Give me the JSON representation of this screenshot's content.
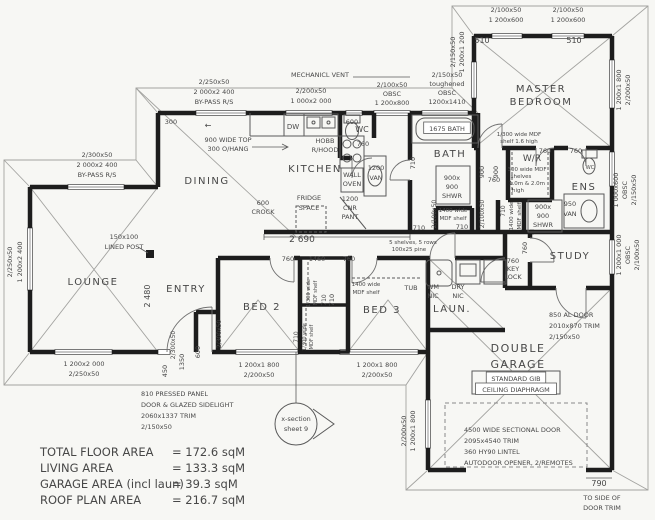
{
  "title": "house-floor-plan",
  "colors": {
    "paper": "#f7f7f4",
    "ink": "#474747",
    "wall": "#1d1d1d",
    "thin": "#9a9a9a"
  },
  "areas": [
    {
      "label": "TOTAL FLOOR AREA",
      "value": "= 172.6 sqM"
    },
    {
      "label": "LIVING AREA",
      "value": "= 133.3 sqM"
    },
    {
      "label": "GARAGE AREA (incl laun)",
      "value": "= 39.3 sqM"
    },
    {
      "label": "ROOF PLAN AREA",
      "value": "= 216.7 sqM"
    }
  ],
  "labels": [
    {
      "n": "win-dining-size",
      "t": "2/250x50",
      "x": 214,
      "y": 84
    },
    {
      "n": "win-dining-glass",
      "t": "2 000x2 400",
      "x": 214,
      "y": 94
    },
    {
      "n": "win-dining-type",
      "t": "BY-PASS R/S",
      "x": 214,
      "y": 104
    },
    {
      "n": "dim-300",
      "t": "300",
      "x": 171,
      "y": 124
    },
    {
      "n": "note-bench-top-1",
      "t": "900 WIDE TOP",
      "x": 228,
      "y": 142
    },
    {
      "n": "note-bench-top-2",
      "t": "300 O/HANG",
      "x": 228,
      "y": 151
    },
    {
      "n": "slider-arrow",
      "t": "←",
      "x": 208,
      "y": 128,
      "s": 8
    },
    {
      "n": "win-lounge-top-size",
      "t": "2/300x50",
      "x": 97,
      "y": 157
    },
    {
      "n": "win-lounge-top-glass",
      "t": "2 000x2 400",
      "x": 97,
      "y": 167
    },
    {
      "n": "win-lounge-top-type",
      "t": "BY-PASS R/S",
      "x": 97,
      "y": 177
    },
    {
      "n": "room-dining",
      "t": "DINING",
      "x": 207,
      "y": 184,
      "s": 10,
      "c": 1
    },
    {
      "n": "room-kitchen",
      "t": "KITCHEN",
      "x": 315,
      "y": 172,
      "s": 10,
      "c": 1
    },
    {
      "n": "note-post-1",
      "t": "150x100",
      "x": 124,
      "y": 239
    },
    {
      "n": "note-post-2",
      "t": "LINED POST",
      "x": 124,
      "y": 249
    },
    {
      "n": "win-lounge-left-size",
      "t": "2/250x50",
      "x": 12,
      "y": 262,
      "r": 1
    },
    {
      "n": "win-lounge-left-glass",
      "t": "1 200x2 400",
      "x": 22,
      "y": 262,
      "r": 1
    },
    {
      "n": "room-lounge",
      "t": "LOUNGE",
      "x": 93,
      "y": 285,
      "s": 10,
      "c": 1
    },
    {
      "n": "win-lounge-s-glass",
      "t": "1 200x2 000",
      "x": 84,
      "y": 366
    },
    {
      "n": "win-lounge-s-size",
      "t": "2/250x50",
      "x": 84,
      "y": 376
    },
    {
      "n": "dim-2480",
      "t": "2 480",
      "x": 150,
      "y": 296,
      "r": 1,
      "s": 8
    },
    {
      "n": "room-entry",
      "t": "ENTRY",
      "x": 186,
      "y": 292,
      "s": 10,
      "c": 1
    },
    {
      "n": "room-bed2",
      "t": "BED 2",
      "x": 262,
      "y": 310,
      "s": 10,
      "c": 1
    },
    {
      "n": "dim-bed2-wall",
      "t": "2/300x50",
      "x": 221,
      "y": 334,
      "r": 1,
      "s": 6
    },
    {
      "n": "dim-450",
      "t": "450",
      "x": 167,
      "y": 371,
      "r": 1
    },
    {
      "n": "dim-entry-wall",
      "t": "2/300x50",
      "x": 175,
      "y": 345,
      "r": 1,
      "s": 6
    },
    {
      "n": "dim-1350",
      "t": "1350",
      "x": 184,
      "y": 362,
      "r": 1
    },
    {
      "n": "dim-600-entry",
      "t": "600",
      "x": 200,
      "y": 352,
      "r": 1
    },
    {
      "n": "door-entry-1",
      "t": "810 PRESSED PANEL",
      "x": 141,
      "y": 396,
      "a": "s"
    },
    {
      "n": "door-entry-2",
      "t": "DOOR & GLAZED SIDELIGHT",
      "x": 141,
      "y": 407,
      "a": "s"
    },
    {
      "n": "door-entry-3",
      "t": "2060x1337 TRIM",
      "x": 141,
      "y": 418,
      "a": "s"
    },
    {
      "n": "door-entry-4",
      "t": "2/150x50",
      "x": 141,
      "y": 429,
      "a": "s"
    },
    {
      "n": "xsection-1",
      "t": "x-section",
      "x": 296,
      "y": 421
    },
    {
      "n": "xsection-2",
      "t": "sheet 9",
      "x": 296,
      "y": 431
    },
    {
      "n": "win-bed2-glass",
      "t": "1 200x1 800",
      "x": 259,
      "y": 367
    },
    {
      "n": "win-bed2-size",
      "t": "2/200x50",
      "x": 259,
      "y": 377
    },
    {
      "n": "win-bed3-glass",
      "t": "1 200x1 800",
      "x": 377,
      "y": 367
    },
    {
      "n": "win-bed3-size",
      "t": "2/200x50",
      "x": 377,
      "y": 377
    },
    {
      "n": "note-mech-vent",
      "t": "MECHANICL VENT",
      "x": 320,
      "y": 77
    },
    {
      "n": "win-kitchen-size",
      "t": "2/200x50",
      "x": 311,
      "y": 93
    },
    {
      "n": "win-kitchen-glass",
      "t": "1 000x2 000",
      "x": 311,
      "y": 103
    },
    {
      "n": "fix-dw",
      "t": "DW",
      "x": 293,
      "y": 129,
      "s": 7
    },
    {
      "n": "dim-600-win",
      "t": "600",
      "x": 352,
      "y": 124
    },
    {
      "n": "fix-hob-1",
      "t": "HOBB",
      "x": 325,
      "y": 143
    },
    {
      "n": "fix-hob-2",
      "t": "R/HOOD",
      "x": 325,
      "y": 152
    },
    {
      "n": "win-wc-size",
      "t": "2/100x50",
      "x": 392,
      "y": 87
    },
    {
      "n": "win-wc-obsc",
      "t": "OBSC",
      "x": 392,
      "y": 96
    },
    {
      "n": "win-wc-glass",
      "t": "1 200x800",
      "x": 392,
      "y": 105
    },
    {
      "n": "win-bath-size",
      "t": "2/150x50",
      "x": 447,
      "y": 77
    },
    {
      "n": "win-bath-tough",
      "t": "toughened",
      "x": 447,
      "y": 86
    },
    {
      "n": "win-bath-obsc",
      "t": "OBSC",
      "x": 447,
      "y": 95
    },
    {
      "n": "win-bath-glass",
      "t": "1200x1410",
      "x": 447,
      "y": 104
    },
    {
      "n": "win-master-w-size",
      "t": "2/150x50",
      "x": 455,
      "y": 52,
      "r": 1
    },
    {
      "n": "win-master-w-glass",
      "t": "1 200x1 200",
      "x": 464,
      "y": 52,
      "r": 1
    },
    {
      "n": "win-master-n1-size",
      "t": "2/100x50",
      "x": 506,
      "y": 12
    },
    {
      "n": "win-master-n1-glass",
      "t": "1 200x600",
      "x": 506,
      "y": 22
    },
    {
      "n": "dim-510-a",
      "t": "510",
      "x": 482,
      "y": 43,
      "s": 8
    },
    {
      "n": "win-master-n2-size",
      "t": "2/100x50",
      "x": 568,
      "y": 12
    },
    {
      "n": "win-master-n2-glass",
      "t": "1 200x600",
      "x": 568,
      "y": 22
    },
    {
      "n": "dim-510-b",
      "t": "510",
      "x": 574,
      "y": 43,
      "s": 8
    },
    {
      "n": "room-master-1",
      "t": "MASTER",
      "x": 541,
      "y": 92,
      "s": 10,
      "c": 1
    },
    {
      "n": "room-master-2",
      "t": "BEDROOM",
      "x": 541,
      "y": 105,
      "s": 10,
      "c": 1
    },
    {
      "n": "win-master-e-glass",
      "t": "1 200x1 800",
      "x": 621,
      "y": 90,
      "r": 1
    },
    {
      "n": "win-master-e-size",
      "t": "2/200x50",
      "x": 630,
      "y": 90,
      "r": 1
    },
    {
      "n": "room-wc",
      "t": "WC",
      "x": 362,
      "y": 132,
      "s": 8
    },
    {
      "n": "dim-760-wc",
      "t": "760",
      "x": 363,
      "y": 146
    },
    {
      "n": "fix-wall-oven-1",
      "t": "WALL",
      "x": 352,
      "y": 177
    },
    {
      "n": "fix-wall-oven-2",
      "t": "OVEN",
      "x": 352,
      "y": 186
    },
    {
      "n": "fix-van1200-1",
      "t": "1200",
      "x": 376,
      "y": 170
    },
    {
      "n": "fix-van1200-2",
      "t": "VAN",
      "x": 376,
      "y": 180
    },
    {
      "n": "fix-bath-label",
      "t": "1675 BATH",
      "x": 447,
      "y": 131,
      "b": 1
    },
    {
      "n": "room-bath",
      "t": "BATH",
      "x": 450,
      "y": 157,
      "s": 10,
      "c": 1
    },
    {
      "n": "dim-710-bath",
      "t": "710",
      "x": 415,
      "y": 163,
      "r": 1
    },
    {
      "n": "fix-shwr-bath-1",
      "t": "900x",
      "x": 452,
      "y": 180
    },
    {
      "n": "fix-shwr-bath-2",
      "t": "900",
      "x": 452,
      "y": 189
    },
    {
      "n": "fix-shwr-bath-3",
      "t": "SHWR",
      "x": 452,
      "y": 198
    },
    {
      "n": "fix-linen-bath-1",
      "t": "1400 wide",
      "x": 453,
      "y": 212,
      "s": 5.5
    },
    {
      "n": "fix-linen-bath-2",
      "t": "MDF shelf",
      "x": 453,
      "y": 220,
      "s": 5.5
    },
    {
      "n": "dim-710-linen",
      "t": "710",
      "x": 462,
      "y": 229
    },
    {
      "n": "dim-900-hall",
      "t": "900",
      "x": 484,
      "y": 172,
      "r": 1
    },
    {
      "n": "dim-760-hall",
      "t": "760",
      "x": 494,
      "y": 182
    },
    {
      "n": "note-wr-shelf-1",
      "t": "1/300 wide MDF",
      "x": 519,
      "y": 136,
      "s": 5.5
    },
    {
      "n": "note-wr-shelf-2",
      "t": "shelf 1.6 high",
      "x": 519,
      "y": 143,
      "s": 5.5
    },
    {
      "n": "room-wr",
      "t": "W/R",
      "x": 532,
      "y": 161,
      "s": 9
    },
    {
      "n": "note-wr-1",
      "t": "300 wide MDF",
      "x": 527,
      "y": 171,
      "s": 5.5
    },
    {
      "n": "note-wr-2",
      "t": "shelves",
      "x": 521,
      "y": 178,
      "s": 5.5
    },
    {
      "n": "note-wr-3",
      "t": "1.0m & 2.0m",
      "x": 527,
      "y": 185,
      "s": 5.5
    },
    {
      "n": "note-wr-4",
      "t": "high",
      "x": 518,
      "y": 192,
      "s": 5.5
    },
    {
      "n": "dim-760-wr",
      "t": "760",
      "x": 545,
      "y": 153
    },
    {
      "n": "dim-760-ens",
      "t": "760",
      "x": 576,
      "y": 153
    },
    {
      "n": "dim-900-wr",
      "t": "900",
      "x": 498,
      "y": 172,
      "r": 1
    },
    {
      "n": "fix-wc-ens",
      "t": "WC",
      "x": 590,
      "y": 169,
      "s": 5
    },
    {
      "n": "room-ens",
      "t": "ENS",
      "x": 584,
      "y": 190,
      "s": 10,
      "c": 1
    },
    {
      "n": "fix-shwr-ens-1",
      "t": "900x",
      "x": 543,
      "y": 209
    },
    {
      "n": "fix-shwr-ens-2",
      "t": "900",
      "x": 543,
      "y": 218
    },
    {
      "n": "fix-shwr-ens-3",
      "t": "SHWR",
      "x": 543,
      "y": 227
    },
    {
      "n": "fix-van950-1",
      "t": "950",
      "x": 570,
      "y": 206
    },
    {
      "n": "fix-van950-2",
      "t": "VAN",
      "x": 570,
      "y": 216
    },
    {
      "n": "win-ens-glass",
      "t": "1 000x600",
      "x": 618,
      "y": 190,
      "r": 1
    },
    {
      "n": "win-ens-obsc",
      "t": "OBSC",
      "x": 627,
      "y": 190,
      "r": 1
    },
    {
      "n": "win-ens-size",
      "t": "2/150x50",
      "x": 636,
      "y": 190,
      "r": 1
    },
    {
      "n": "dim-2690",
      "t": "2 690",
      "x": 302,
      "y": 242,
      "s": 9
    },
    {
      "n": "fix-crock-1",
      "t": "600",
      "x": 263,
      "y": 205
    },
    {
      "n": "fix-crock-2",
      "t": "CROCK",
      "x": 263,
      "y": 214
    },
    {
      "n": "fix-fridge-1",
      "t": "FRIDGE",
      "x": 309,
      "y": 200
    },
    {
      "n": "fix-fridge-2",
      "t": "SPACE",
      "x": 309,
      "y": 210
    },
    {
      "n": "fix-pantry-1",
      "t": "1200",
      "x": 350,
      "y": 201
    },
    {
      "n": "fix-pantry-2",
      "t": "CNR",
      "x": 350,
      "y": 210
    },
    {
      "n": "fix-pantry-3",
      "t": "PANT",
      "x": 350,
      "y": 219
    },
    {
      "n": "note-shelves-1",
      "t": "5 shelves, 5 rows",
      "x": 413,
      "y": 244,
      "s": 5.5
    },
    {
      "n": "note-shelves-2",
      "t": "100x25 pine",
      "x": 409,
      "y": 251,
      "s": 5.5
    },
    {
      "n": "dim-710-hall",
      "t": "710",
      "x": 419,
      "y": 230
    },
    {
      "n": "dim-lintel-a",
      "t": "2/100x50",
      "x": 436,
      "y": 214,
      "r": 1,
      "s": 6
    },
    {
      "n": "dim-lintel-b",
      "t": "2/100x50",
      "x": 484,
      "y": 214,
      "r": 1,
      "s": 6
    },
    {
      "n": "dim-710-linen2",
      "t": "710",
      "x": 505,
      "y": 211,
      "r": 1,
      "s": 6
    },
    {
      "n": "note-linen2-1",
      "t": "1400 wide",
      "x": 513,
      "y": 216,
      "r": 1,
      "s": 5.5
    },
    {
      "n": "note-linen2-2",
      "t": "MDF shelf",
      "x": 521,
      "y": 216,
      "r": 1,
      "s": 5.5
    },
    {
      "n": "room-study",
      "t": "STUDY",
      "x": 570,
      "y": 259,
      "s": 10,
      "c": 1
    },
    {
      "n": "dim-760-study",
      "t": "760",
      "x": 527,
      "y": 248,
      "r": 1
    },
    {
      "n": "door-key-1",
      "t": "760",
      "x": 513,
      "y": 263
    },
    {
      "n": "door-key-2",
      "t": "KEY",
      "x": 513,
      "y": 271
    },
    {
      "n": "door-key-3",
      "t": "LOCK",
      "x": 513,
      "y": 279
    },
    {
      "n": "win-study-glass",
      "t": "1 200x1 000",
      "x": 621,
      "y": 255,
      "r": 1
    },
    {
      "n": "win-study-obsc",
      "t": "OBSC",
      "x": 630,
      "y": 255,
      "r": 1
    },
    {
      "n": "win-study-size",
      "t": "2/100x50",
      "x": 639,
      "y": 255,
      "r": 1
    },
    {
      "n": "fix-tub",
      "t": "TUB",
      "x": 411,
      "y": 290
    },
    {
      "n": "fix-wm-1",
      "t": "WM",
      "x": 433,
      "y": 289
    },
    {
      "n": "fix-wm-2",
      "t": "NIC",
      "x": 433,
      "y": 298
    },
    {
      "n": "fix-dry-1",
      "t": "DRY",
      "x": 458,
      "y": 289
    },
    {
      "n": "fix-dry-2",
      "t": "NIC",
      "x": 458,
      "y": 298
    },
    {
      "n": "room-laun",
      "t": "LAUN.",
      "x": 452,
      "y": 312,
      "s": 10,
      "c": 1
    },
    {
      "n": "room-bed3",
      "t": "BED 3",
      "x": 382,
      "y": 313,
      "s": 10,
      "c": 1
    },
    {
      "n": "note-robe3-1",
      "t": "1400 wide",
      "x": 366,
      "y": 286,
      "s": 5.5
    },
    {
      "n": "note-robe3-2",
      "t": "MDF shelf",
      "x": 366,
      "y": 294,
      "s": 5.5
    },
    {
      "n": "dim-710-bed3",
      "t": "710",
      "x": 334,
      "y": 300,
      "r": 1
    },
    {
      "n": "dim-1460",
      "t": "1460",
      "x": 317,
      "y": 261
    },
    {
      "n": "dim-760-bed2",
      "t": "760",
      "x": 288,
      "y": 261
    },
    {
      "n": "dim-760-bed3",
      "t": "760",
      "x": 349,
      "y": 261
    },
    {
      "n": "note-closet1-1",
      "t": "1/300 wide",
      "x": 310,
      "y": 293,
      "r": 1,
      "s": 5
    },
    {
      "n": "note-closet1-2",
      "t": "MDF shelf",
      "x": 317,
      "y": 293,
      "r": 1,
      "s": 5
    },
    {
      "n": "dim-710-closet1",
      "t": "710",
      "x": 326,
      "y": 300,
      "r": 1,
      "s": 6
    },
    {
      "n": "note-closet2-1",
      "t": "1/300 wide",
      "x": 306,
      "y": 337,
      "r": 1,
      "s": 5
    },
    {
      "n": "note-closet2-2",
      "t": "MDF shelf",
      "x": 313,
      "y": 337,
      "r": 1,
      "s": 5
    },
    {
      "n": "dim-710-closet2",
      "t": "710",
      "x": 298,
      "y": 337,
      "r": 1,
      "s": 6
    },
    {
      "n": "door-al-1",
      "t": "850 AL DOOR",
      "x": 549,
      "y": 317,
      "a": "s"
    },
    {
      "n": "door-al-2",
      "t": "2010x870 TRIM",
      "x": 549,
      "y": 328,
      "a": "s"
    },
    {
      "n": "door-al-3",
      "t": "2/150x50",
      "x": 549,
      "y": 339,
      "a": "s"
    },
    {
      "n": "room-garage-1",
      "t": "DOUBLE",
      "x": 518,
      "y": 352,
      "s": 11,
      "c": 1
    },
    {
      "n": "room-garage-2",
      "t": "GARAGE",
      "x": 518,
      "y": 368,
      "s": 11,
      "c": 1
    },
    {
      "n": "note-gib-1",
      "t": "STANDARD GIB",
      "x": 516,
      "y": 381,
      "b": 1
    },
    {
      "n": "note-gib-2",
      "t": "CEILING DIAPHRAGM",
      "x": 516,
      "y": 392,
      "b": 1
    },
    {
      "n": "door-sectional-1",
      "t": "4500 WIDE SECTIONAL DOOR",
      "x": 464,
      "y": 432,
      "a": "s"
    },
    {
      "n": "door-sectional-2",
      "t": "2095x4540 TRIM",
      "x": 464,
      "y": 443,
      "a": "s"
    },
    {
      "n": "door-sectional-3",
      "t": "360 HY90 LINTEL",
      "x": 464,
      "y": 454,
      "a": "s"
    },
    {
      "n": "door-sectional-4",
      "t": "AUTODOOR OPENER, 2/REMOTES",
      "x": 464,
      "y": 465,
      "a": "s"
    },
    {
      "n": "dim-790",
      "t": "790",
      "x": 599,
      "y": 486,
      "s": 8
    },
    {
      "n": "note-trim-1",
      "t": "TO SIDE OF",
      "x": 602,
      "y": 500
    },
    {
      "n": "note-trim-2",
      "t": "DOOR TRIM",
      "x": 602,
      "y": 510
    },
    {
      "n": "win-garage-size",
      "t": "2/200x50",
      "x": 406,
      "y": 431,
      "r": 1
    },
    {
      "n": "win-garage-glass",
      "t": "1 200x1 800",
      "x": 415,
      "y": 431,
      "r": 1
    }
  ]
}
